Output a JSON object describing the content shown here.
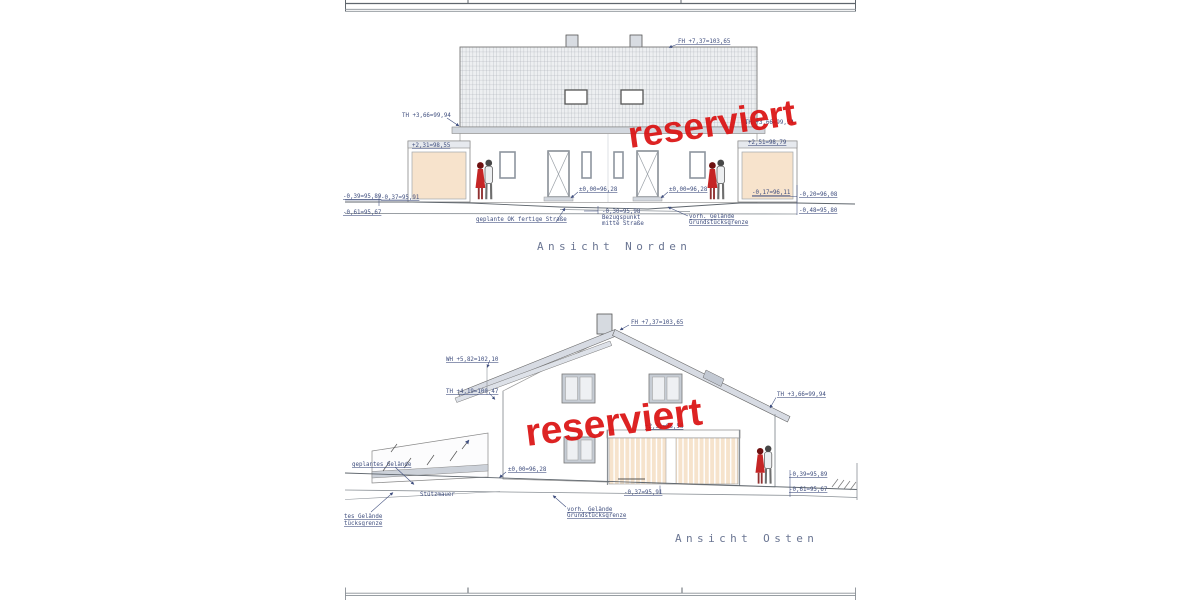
{
  "stamps": {
    "north": "reserviert",
    "east": "reserviert"
  },
  "north": {
    "title": "Ansicht Norden",
    "labels": {
      "fh": "FH +7,37=103,65",
      "th_left": "TH +3,66=99,94",
      "th_right": "TH +3,66=99,94",
      "garage_left": "+2,31=98,55",
      "garage_right": "+2,51=98,79",
      "zero_left": "±0,00=96,28",
      "zero_right": "±0,00=96,28",
      "m039": "-0,39=95,89",
      "m037": "-0,37=95,91",
      "m061": "-0,61=95,67",
      "m017": "-0,17=96,11",
      "m020": "-0,20=96,08",
      "m048": "-0,48=95,80",
      "street": "geplante OK fertige Straße",
      "ref1": "-0,30=95,98",
      "ref2": "Bezugspunkt",
      "ref3": "mitte Straße",
      "terrain1": "vorh. Gelände",
      "terrain2": "Grundstücksgrenze"
    }
  },
  "east": {
    "title": "Ansicht Osten",
    "labels": {
      "fh": "FH +7,37=103,65",
      "wh": "WH +5,82=102,10",
      "th_left": "TH +4,19=100,47",
      "th_right": "TH +3,66=99,94",
      "fence": "+2,31=98,58",
      "zero": "±0,00=96,28",
      "m037": "-0,37=95,91",
      "m039": "-0,39=95,89",
      "m061": "-0,61=95,67",
      "planned_ground": "geplantes Gelände",
      "retaining_wall": "Stützmauer",
      "cut1": "tes Gelände",
      "cut2": "tücksgrenze",
      "terrain1": "vorh. Gelände",
      "terrain2": "Grundstücksgrenze"
    }
  },
  "colors": {
    "stamp_red": "#db1111",
    "label_blue": "#3f4e7e",
    "title_gray": "#6b7693",
    "roof_grid": "#a5aab2",
    "band_gray": "#d3d8df",
    "door_peach": "#f7e3cc"
  }
}
